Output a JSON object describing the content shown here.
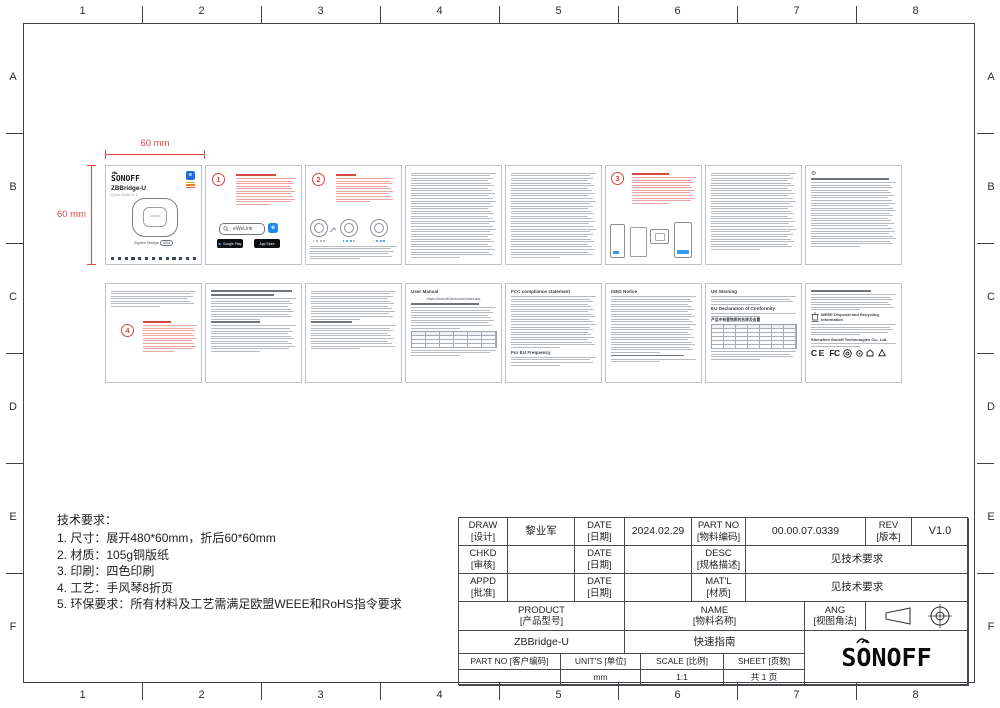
{
  "frame": {
    "cols": [
      "1",
      "2",
      "3",
      "4",
      "5",
      "6",
      "7",
      "8"
    ],
    "rows": [
      "A",
      "B",
      "C",
      "D",
      "E",
      "F"
    ]
  },
  "dims": {
    "width": "60 mm",
    "height": "60 mm"
  },
  "cover": {
    "brand": "SONOFF",
    "model": "ZBBridge-U",
    "edition": "Quick Guide V1.1",
    "device_label": "SONOFF",
    "product": "Zigbee Bridge",
    "variant": "Ultra"
  },
  "steps": {
    "s1": "1",
    "s2": "2",
    "s3": "3",
    "s4": "4"
  },
  "app": {
    "search": "eWeLink",
    "icon_letter": "e",
    "store_google": "Google Play",
    "store_apple": "App Store"
  },
  "docs": {
    "user_manual": "User Manual",
    "manual_url": "https://sonoff.tech/usermanuals",
    "fcc_title": "FCC compliance statement",
    "eu_freq": "For EU Frequency",
    "ised_title": "ISED Notice",
    "uk_warning": "UK Warning",
    "eu_doc": "EU Declaration of Conformity",
    "hazard_title": "产品中有害物质的名称及含量",
    "weee_title": "WEEE Disposal and Recycling Information",
    "company": "Shenzhen Sonoff Technologies Co., Ltd.",
    "ce": "CE",
    "fcc_mark": "FC"
  },
  "tech": {
    "title": "技术要求：",
    "items": [
      "1. 尺寸：展开480*60mm，折后60*60mm",
      "2. 材质：105g铜版纸",
      "3. 印刷：四色印刷",
      "4. 工艺：手风琴8折页",
      "5. 环保要求：所有材料及工艺需满足欧盟WEEE和RoHS指令要求"
    ]
  },
  "tb": {
    "draw": "DRAW",
    "draw_cn": "[设计]",
    "draw_val": "黎业军",
    "date": "DATE",
    "date_cn": "[日期]",
    "date_val": "2024.02.29",
    "partno": "PART NO",
    "partno_cn": "[物料编码]",
    "partno_val": "00.00.07.0339",
    "rev": "REV",
    "rev_cn": "[版本]",
    "rev_val": "V1.0",
    "chkd": "CHKD",
    "chkd_cn": "[审核]",
    "desc": "DESC",
    "desc_cn": "[规格描述]",
    "desc_val": "见技术要求",
    "appd": "APPD",
    "appd_cn": "[批准]",
    "matl": "MAT'L",
    "matl_cn": "[材质]",
    "matl_val": "见技术要求",
    "product": "PRODUCT",
    "product_cn": "[产品型号]",
    "product_val": "ZBBridge-U",
    "name": "NAME",
    "name_cn": "[物料名称]",
    "name_val": "快速指南",
    "ang": "ANG",
    "ang_cn": "[视图角法]",
    "cust": "PART NO [客户编码]",
    "units": "UNIT'S [单位]",
    "units_val": "mm",
    "scale": "SCALE [比例]",
    "scale_val": "1:1",
    "sheet": "SHEET [页数]",
    "sheet_val": "共 1 页",
    "logo": "SONOFF"
  }
}
